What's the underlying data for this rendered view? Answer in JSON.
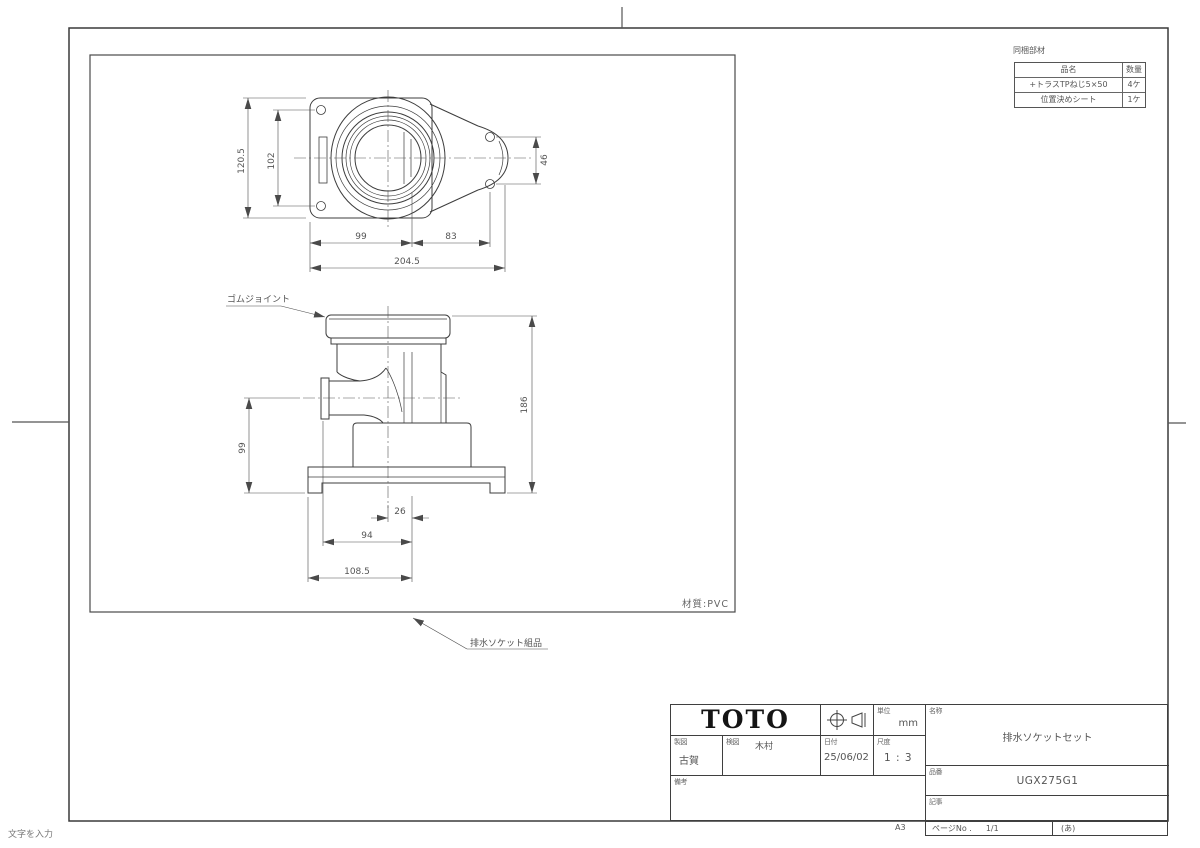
{
  "page": {
    "input_hint": "文字を入力",
    "paper_size": "A3"
  },
  "parts_table": {
    "title": "同梱部材",
    "col_name": "品名",
    "col_qty": "数量",
    "rows": [
      {
        "name": "+トラスTPねじ5×50",
        "qty": "4ケ"
      },
      {
        "name": "位置決めシート",
        "qty": "1ケ"
      }
    ]
  },
  "drawing": {
    "rubber_joint_label": "ゴムジョイント",
    "material_label": "材質:PVC",
    "assembly_label": "排水ソケット組品",
    "top_dims": {
      "overall_h": "120.5",
      "pitch_h": "102",
      "nose_pitch": "46",
      "left_span": "99",
      "right_span": "83",
      "overall_w": "204.5"
    },
    "front_dims": {
      "overall_h": "186",
      "spigot_h": "99",
      "offset": "26",
      "base_w": "94",
      "flange_w": "108.5"
    }
  },
  "title_block": {
    "logo": "TOTO",
    "unit_label": "単位",
    "unit": "mm",
    "drafter_label": "製図",
    "drafter": "古賀",
    "checker_label": "検図",
    "checker": "木村",
    "date_label": "日付",
    "date": "25/06/02",
    "scale_label": "尺度",
    "scale": "1 : 3",
    "remarks_label": "備考",
    "name_label": "名称",
    "name": "排水ソケットセット",
    "part_no_label": "品番",
    "part_no": "UGX275G1",
    "notes_label": "記事",
    "page_label": "ページNo .",
    "page_value": "1/1",
    "rev": "(あ)"
  }
}
